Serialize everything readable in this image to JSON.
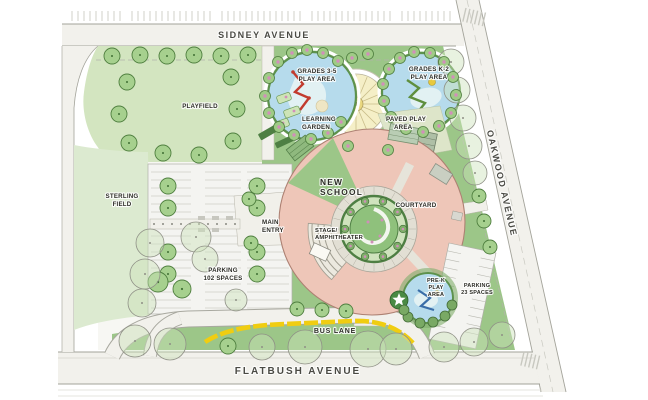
{
  "plan_type": "school campus site plan",
  "labels": {
    "sidney": "SIDNEY AVENUE",
    "oakwood": "OAKWOOD AVENUE",
    "flatbush": "FLATBUSH AVENUE",
    "bus_lane": "BUS LANE",
    "playfield": "PLAYFIELD",
    "sterling": {
      "l1": "STERLING",
      "l2": "FIELD"
    },
    "grades35": {
      "l1": "GRADES 3-5",
      "l2": "PLAY AREA"
    },
    "gradesk2": {
      "l1": "GRADES K-2",
      "l2": "PLAY AREA"
    },
    "learning": {
      "l1": "LEARNING",
      "l2": "GARDEN"
    },
    "paved": {
      "l1": "PAVED PLAY",
      "l2": "AREA"
    },
    "new_school": {
      "l1": "NEW",
      "l2": "SCHOOL"
    },
    "courtyard": "COURTYARD",
    "stage": {
      "l1": "STAGE/",
      "l2": "AMPHITHEATER"
    },
    "main_entry": {
      "l1": "MAIN",
      "l2": "ENTRY"
    },
    "parking_main": {
      "l1": "PARKING",
      "l2": "102 SPACES"
    },
    "prek": {
      "l1": "PRE-K",
      "l2": "PLAY",
      "l3": "AREA"
    },
    "parking_small": {
      "l1": "PARKING",
      "l2": "23 SPACES"
    }
  },
  "colors": {
    "building_pink": "#eec6b8",
    "lawn_green": "#9cc688",
    "field_light_green": "#d3e5c0",
    "play_water_blue": "#b6dbec",
    "bus_lane_yellow": "#f0cd11",
    "road_gray": "#f2f1ec",
    "tree_green": "#a6d08e",
    "ring_green": "#5d924d"
  }
}
